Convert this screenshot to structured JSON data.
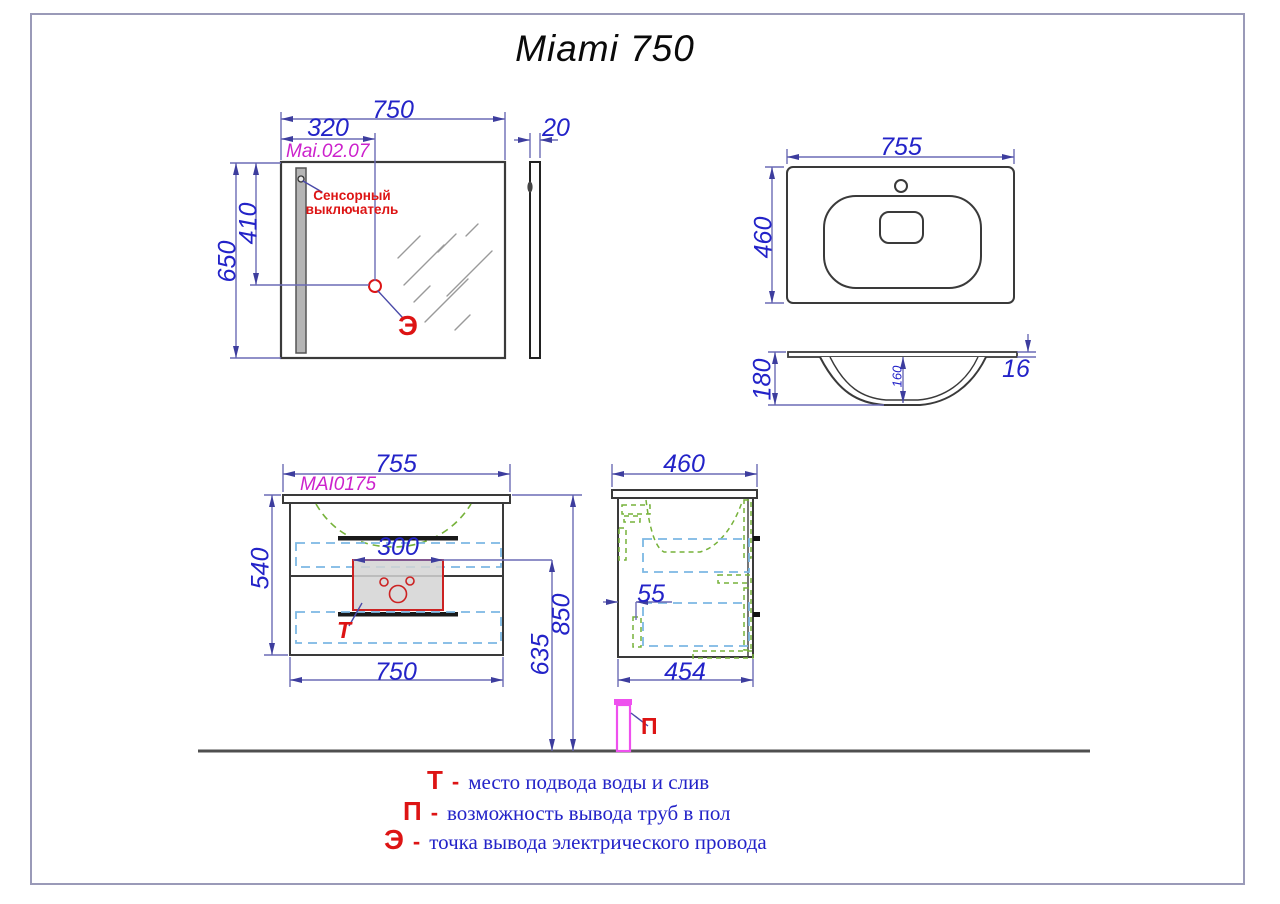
{
  "title": "Miami 750",
  "views": {
    "mirror_front": {
      "code": "Mai.02.07",
      "dims": {
        "width": "750",
        "switch_x": "320",
        "height": "650",
        "switch_y": "410"
      },
      "switch_label": {
        "line1": "Сенсорный",
        "line2": "выключатель"
      },
      "electric_marker": "Э"
    },
    "mirror_side": {
      "dims": {
        "thickness": "20"
      }
    },
    "sink_top": {
      "dims": {
        "width": "755",
        "depth": "460"
      }
    },
    "sink_section": {
      "dims": {
        "height": "180",
        "bowl_depth": "160",
        "rim": "16"
      }
    },
    "cabinet_front": {
      "code": "MAI0175",
      "dims": {
        "width_top": "755",
        "height": "540",
        "cutout": "300",
        "width_bottom": "750",
        "total_height": "850",
        "drain_height": "635"
      },
      "water_marker": "Т"
    },
    "cabinet_side": {
      "dims": {
        "depth_top": "460",
        "pipe_offset": "55",
        "depth_bottom": "454"
      },
      "floor_marker": "П"
    }
  },
  "legend": [
    {
      "marker": "Т",
      "dash": "-",
      "text": "место подвода воды и слив"
    },
    {
      "marker": "П",
      "dash": "-",
      "text": "возможность вывода труб в пол"
    },
    {
      "marker": "Э",
      "dash": "-",
      "text": "точка вывода электрического провода"
    }
  ],
  "colors": {
    "dimension": "#2323c8",
    "outline": "#3a3a3a",
    "code_magenta": "#cc22cc",
    "marker_red": "#dd1414",
    "hidden_green": "#76b23a",
    "drawer_cyan": "#7cb8e4",
    "pipe_magenta": "#ee50ee",
    "floor": "#4f4f4f",
    "frame": "#9a9ab8"
  }
}
